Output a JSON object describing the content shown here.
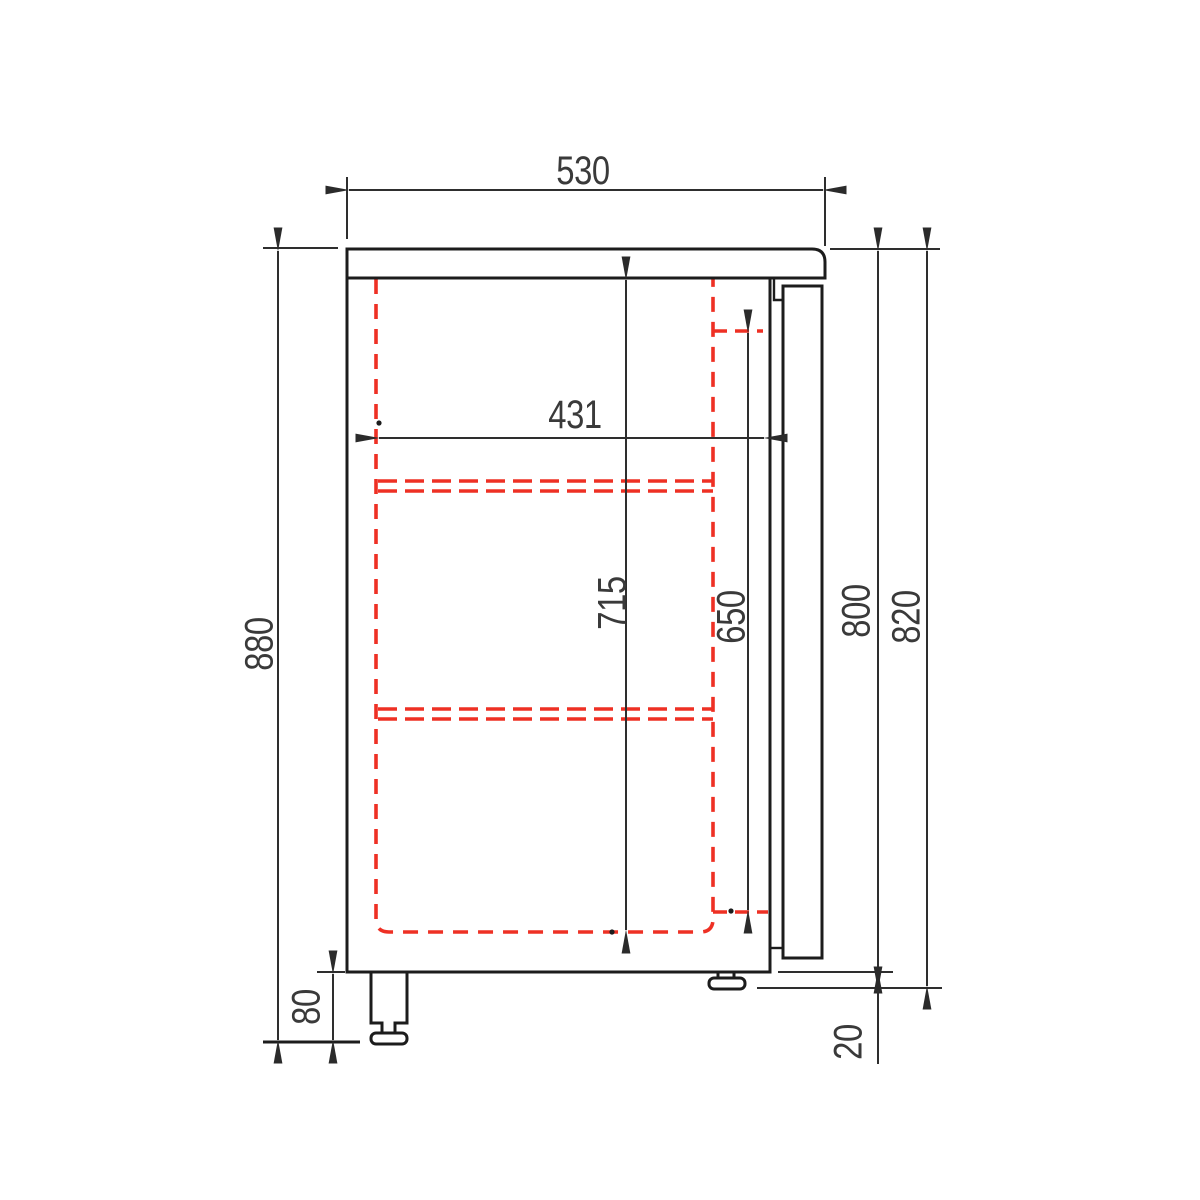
{
  "drawing": {
    "kind": "refrigerated-counter-side-view",
    "units": "mm",
    "colors": {
      "outline": "#1c1c1c",
      "dimension": "#2e2e2e",
      "dashed_interior": "#ee3024",
      "text": "#3a3a3a",
      "background": "#ffffff"
    },
    "dimensions": {
      "worktop_depth": {
        "value": 530,
        "label": "530"
      },
      "interior_depth": {
        "value": 431,
        "label": "431"
      },
      "interior_height": {
        "value": 715,
        "label": "715"
      },
      "liner_height": {
        "value": 650,
        "label": "650"
      },
      "body_height": {
        "value": 800,
        "label": "800"
      },
      "body_door_height": {
        "value": 820,
        "label": "820"
      },
      "overall_height": {
        "value": 880,
        "label": "880"
      },
      "foot_height": {
        "value": 80,
        "label": "80"
      },
      "door_overhang": {
        "value": 20,
        "label": "20"
      }
    }
  }
}
